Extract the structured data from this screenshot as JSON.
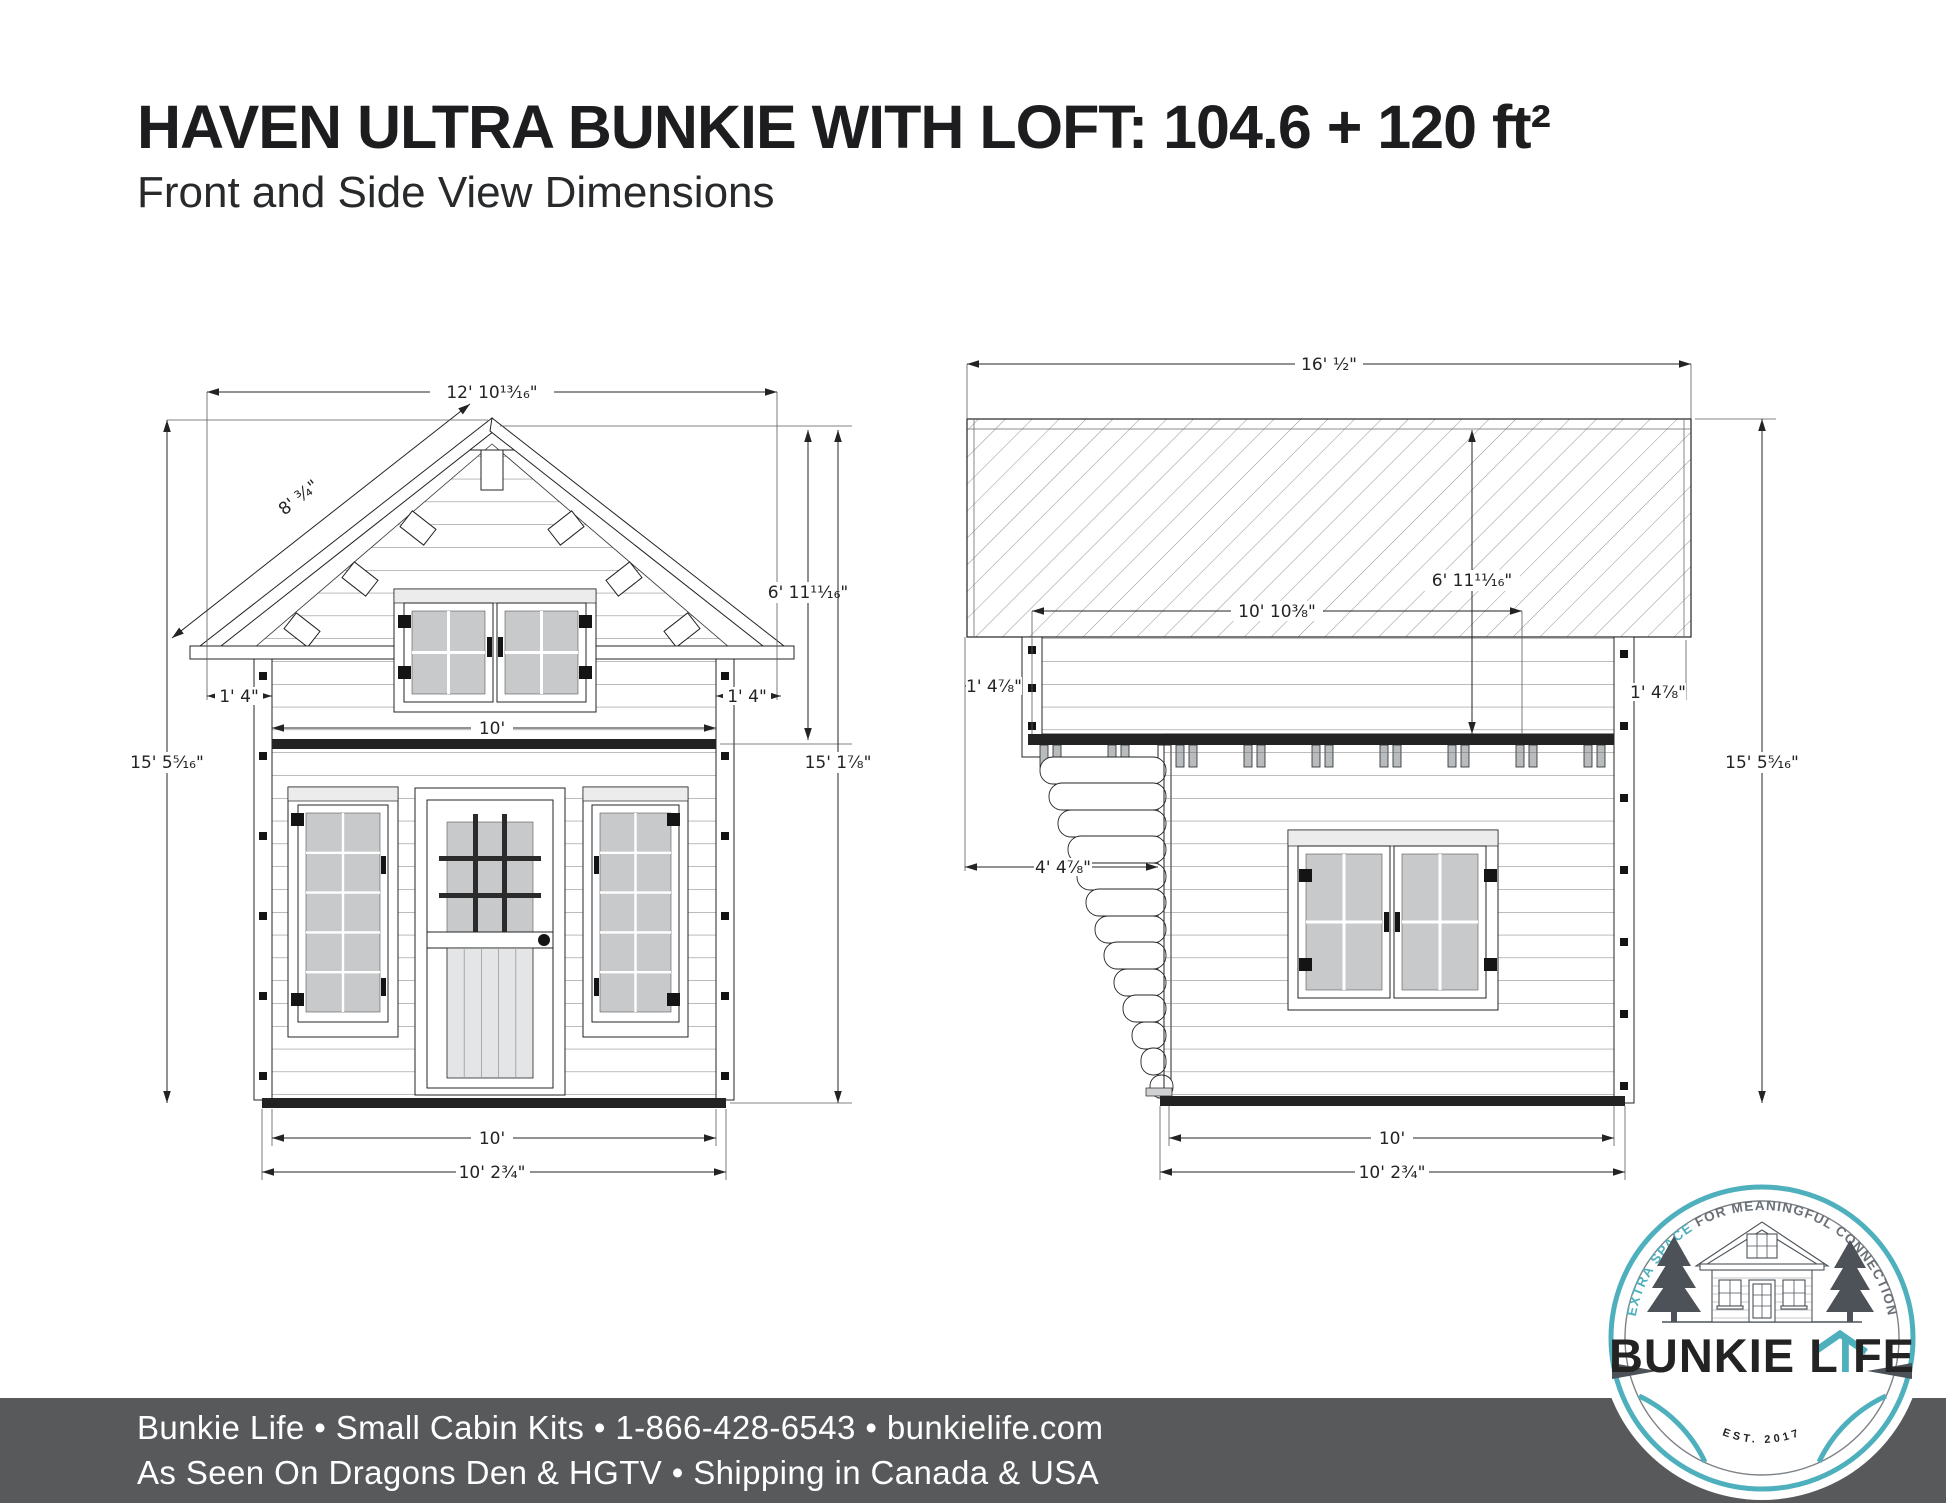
{
  "title": "HAVEN ULTRA BUNKIE WITH LOFT: 104.6 + 120 ft²",
  "subtitle": "Front and Side View Dimensions",
  "fv": {
    "roof_width": "12' 10¹³⁄₁₆\"",
    "slope_length": "8' ³⁄₄\"",
    "loft_height": "6' 11¹¹⁄₁₆\"",
    "overhang_left": "1' 4\"",
    "overhang_right": "1' 4\"",
    "loft_floor_width": "10'",
    "total_height": "15' 5⁵⁄₁₆\"",
    "wall_height": "15' 1⁷⁄₈\"",
    "base_width": "10'",
    "overall_width": "10' 2³⁄₄\""
  },
  "sv": {
    "roof_length": "16' ¹⁄₂\"",
    "loft_height": "6' 11¹¹⁄₁₆\"",
    "loft_floor_length": "10' 10³⁄₈\"",
    "overhang_left": "1' 4⁷⁄₈\"",
    "overhang_right": "1' 4⁷⁄₈\"",
    "total_height": "15' 5⁵⁄₁₆\"",
    "porch_depth": "4' 4⁷⁄₈\"",
    "base_depth": "10'",
    "overall_depth": "10' 2³⁄₄\""
  },
  "logo": {
    "arc1": "EXTRA SPACE ",
    "arc2": "FOR MEANINGFUL ",
    "arc3": "CONNECTION",
    "brand1": "BUNKIE L",
    "brand_i": "I",
    "brand2": "FE",
    "est": "EST.  2017"
  },
  "footer": {
    "line1": "Bunkie Life  •  Small Cabin Kits  •  1-866-428-6543  •  bunkielife.com",
    "line2": "As Seen On Dragons Den & HGTV  •  Shipping in Canada & USA"
  },
  "colors": {
    "teal": "#4fb0bd",
    "ink": "#232323",
    "footer_bg": "#58595b",
    "glass_gray": "#c7c9cb",
    "logo_gray": "#4c5257"
  }
}
